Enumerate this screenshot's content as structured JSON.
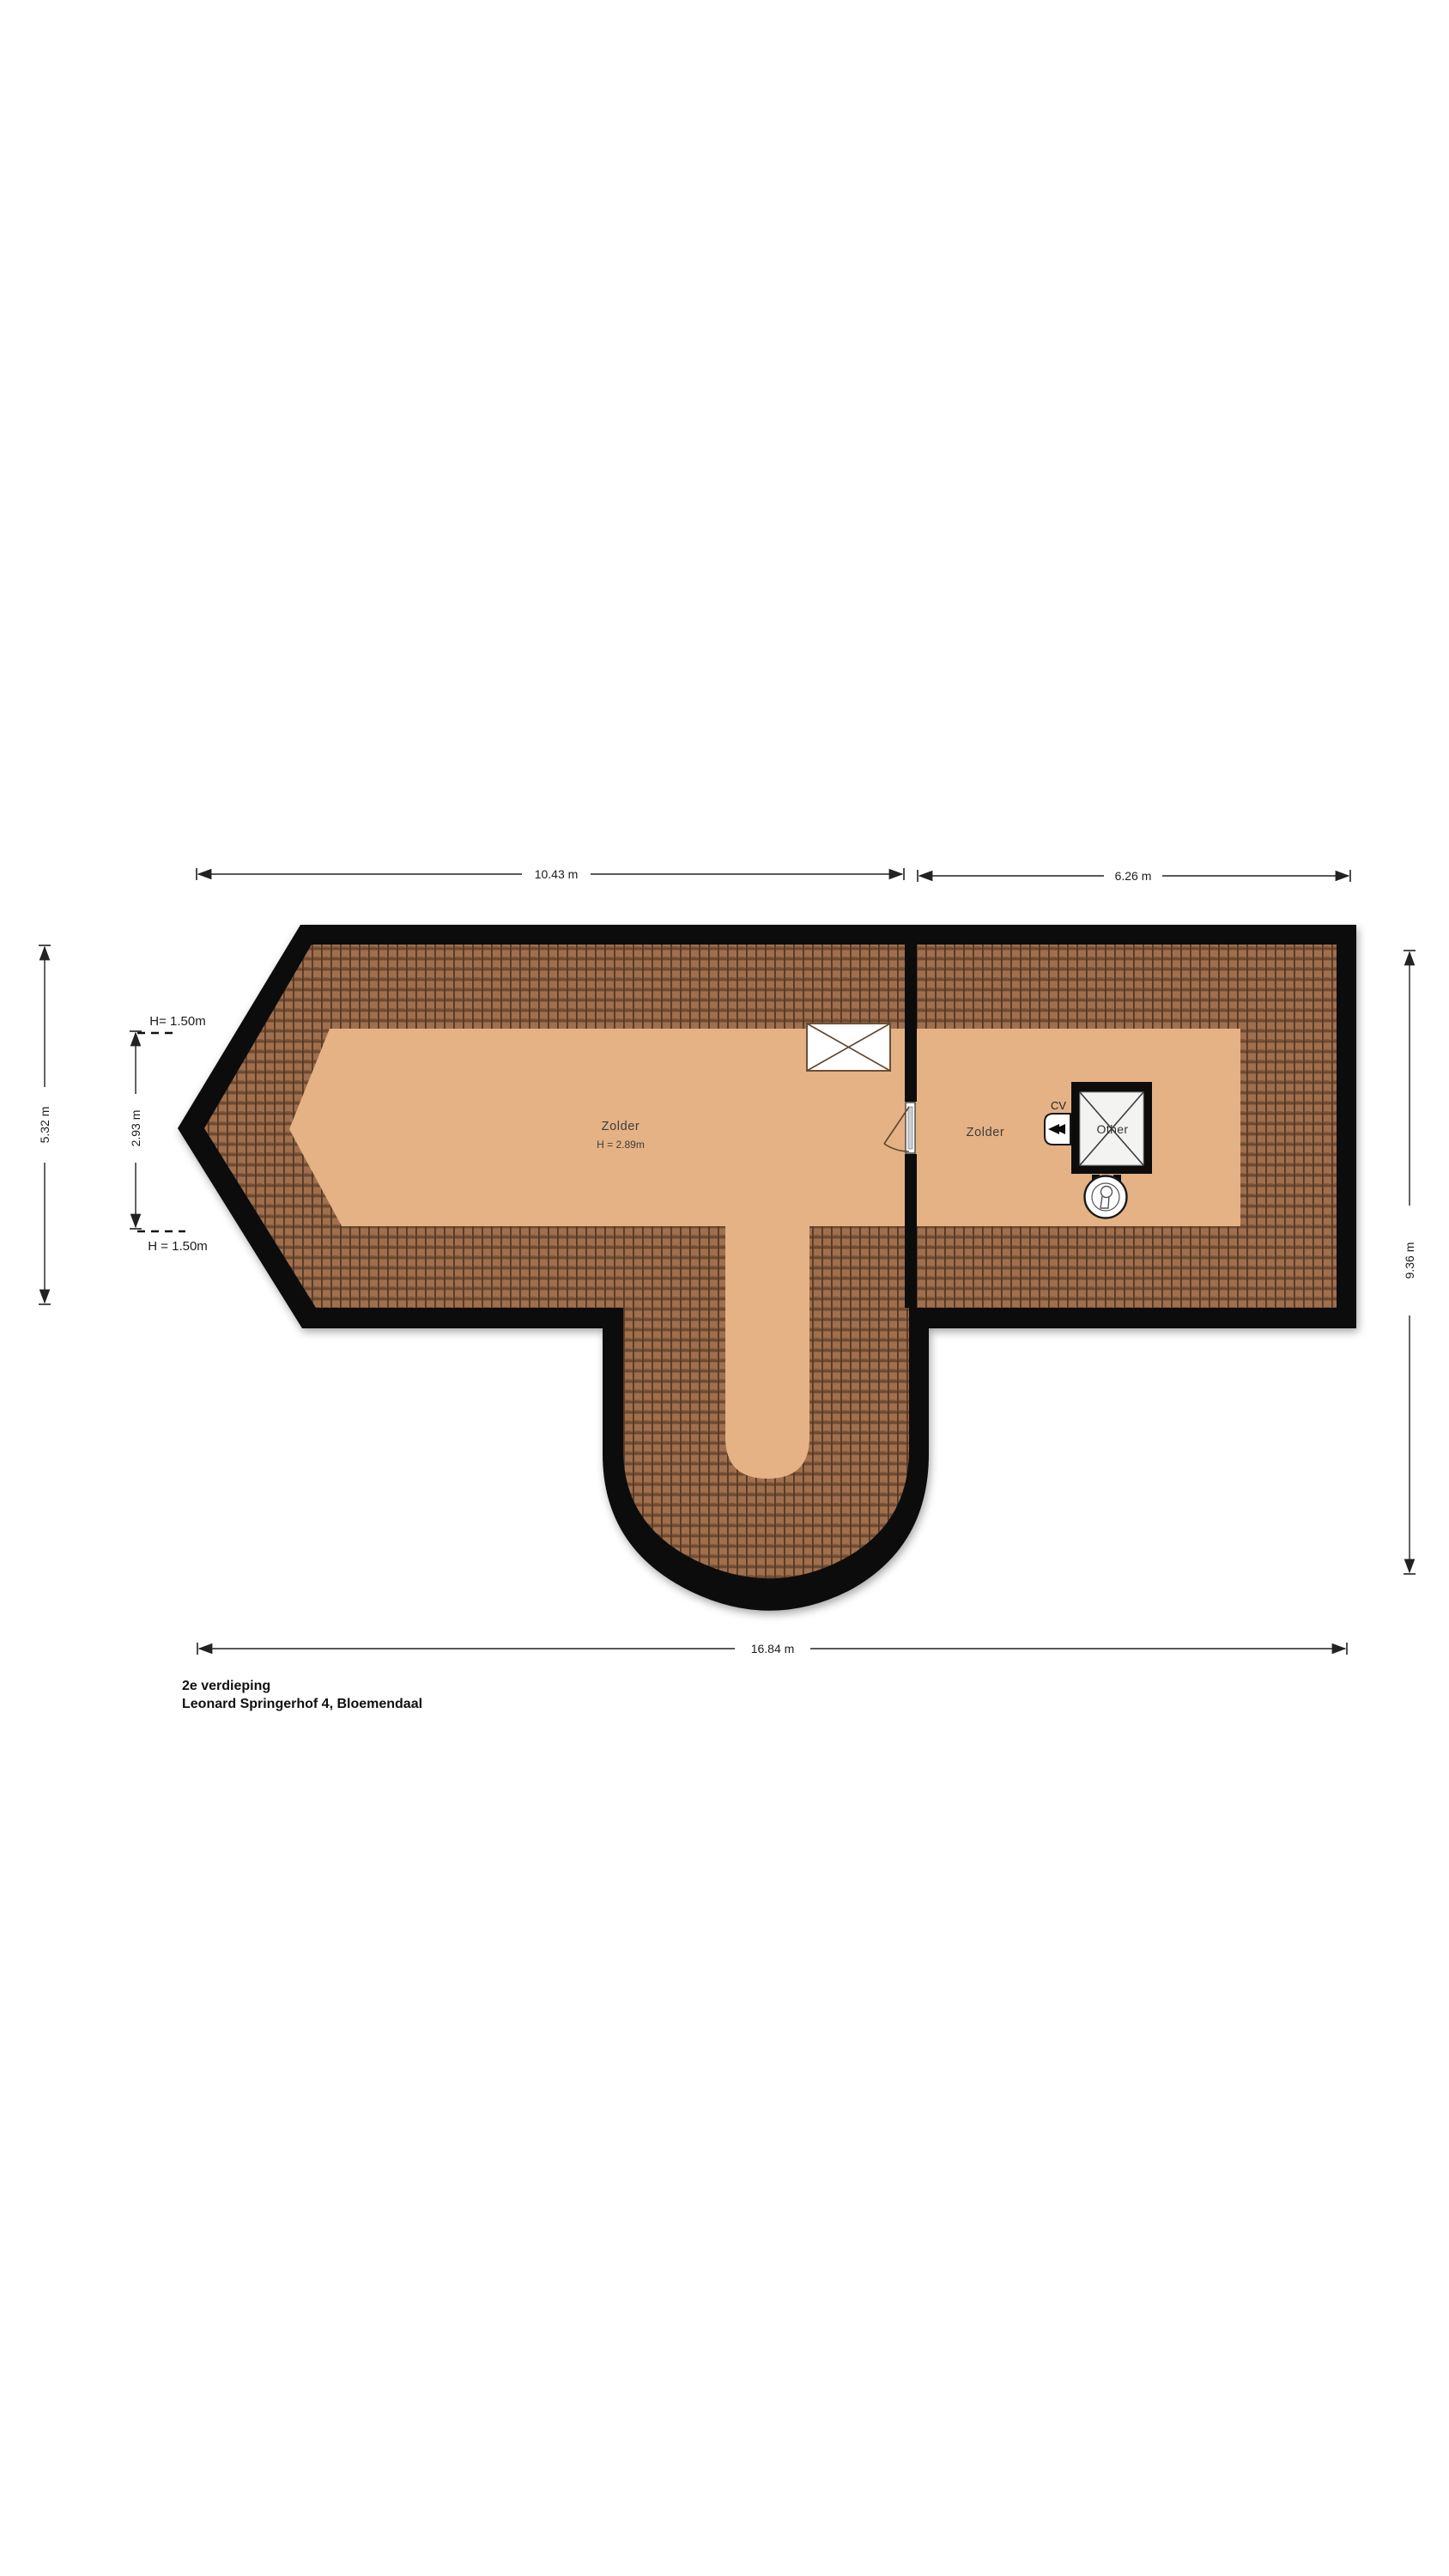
{
  "floorplan": {
    "floor_title": "2e verdieping",
    "address": "Leonard Springerhof 4, Bloemendaal",
    "rooms": [
      {
        "name": "Zolder",
        "ceiling_height": "H = 2.89m"
      },
      {
        "name": "Zolder"
      }
    ],
    "labels": {
      "cv_unit": "CV",
      "shaft": "Other",
      "headroom_top": "H= 1.50m",
      "headroom_bottom": "H = 1.50m"
    },
    "dimensions": {
      "top_left_width": "10.43 m",
      "top_right_width": "6.26 m",
      "total_width": "16.84 m",
      "left_total_height": "5.32 m",
      "left_inner_height": "2.93 m",
      "right_height": "9.36 m"
    },
    "icons": {
      "roof_window": "rectangle-with-x-cross",
      "shaft_cross": "square-with-x-cross",
      "cv_boiler": "rounded-box-with-double-arrow",
      "mv_unit": "circle-with-bulb-glyph",
      "door": "leaf-with-quarter-swing-arc"
    },
    "colors": {
      "background": "#ffffff",
      "wall": "#0c0c0c",
      "floor": "#e4b284",
      "roof_base": "#9f6f4e",
      "roof_line_dark": "#553823",
      "roof_line_mid": "#6e4a31",
      "dimension_line": "#222222",
      "label_text": "#3d3d3d"
    }
  }
}
